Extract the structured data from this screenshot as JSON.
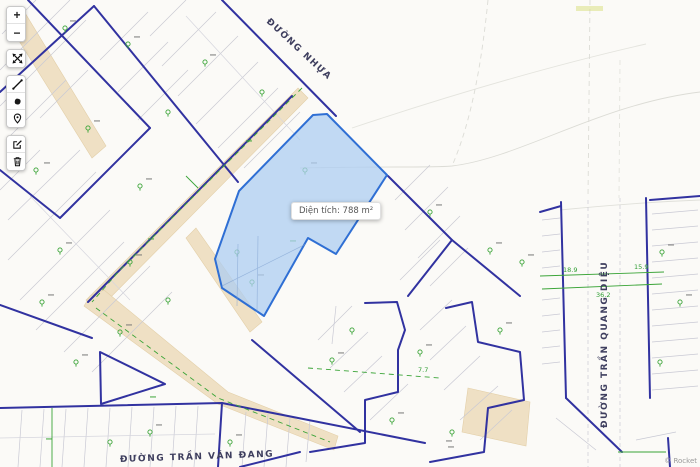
{
  "toolbar": {
    "zoom_in_label": "+",
    "zoom_out_label": "−",
    "icons": {
      "expand": "expand-arrows",
      "measure": "diagonal-line",
      "draw": "ink-blob",
      "marker": "location-pin",
      "edit": "edit-square",
      "delete": "trash-can"
    }
  },
  "map": {
    "streets": {
      "top_diagonal": "ĐƯỜNG NHỰA",
      "bottom": "ĐƯỜNG TRẦN VĂN ĐANG",
      "right_vertical": "ĐƯỜNG TRẦN QUANG DIỆU"
    },
    "tooltip_label": "Diện tích: 788 m²",
    "measurements": {
      "seg_a": "18.9",
      "seg_b": "15.9",
      "seg_c": "36.2",
      "seg_d": "7.7"
    },
    "attribution": "© Rocket",
    "colors": {
      "background": "#fbfaf7",
      "parcel_border": "#3132a0",
      "parcel_thin_line": "#c9c9d4",
      "road_fill": "#efe0c4",
      "survey_green": "#3aa437",
      "highlight_fill": "#aecdf2",
      "highlight_border": "#2f6fd4"
    }
  }
}
